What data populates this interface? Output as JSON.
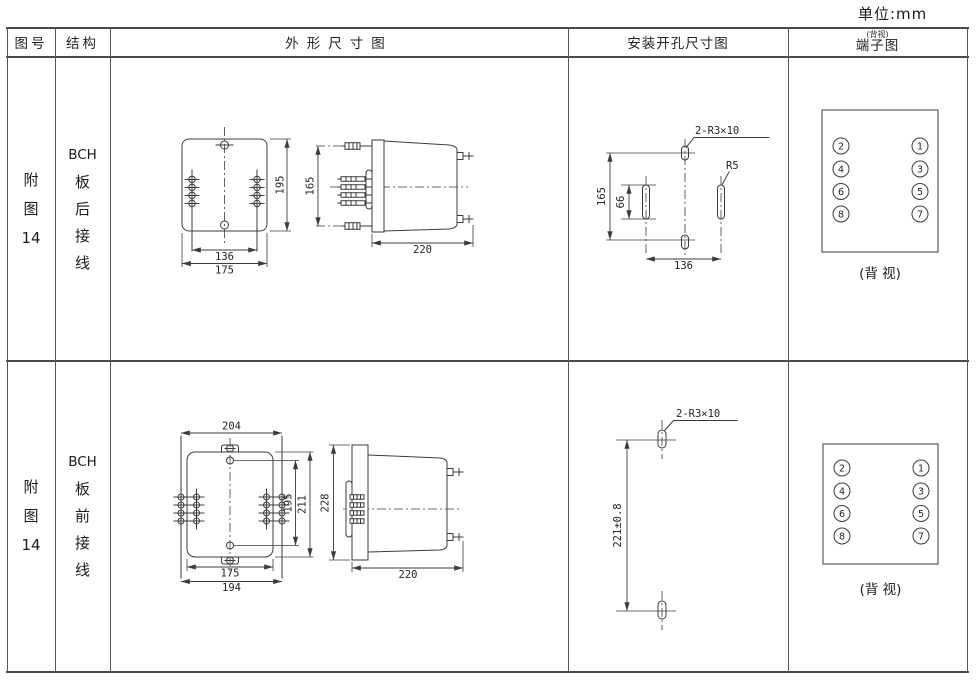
{
  "unit_label": "单位:mm",
  "header": {
    "figure_no": "图号",
    "structure": "结构",
    "outline": "外形尺寸图",
    "mounting": "安装开孔尺寸图",
    "terminal": "端子图",
    "terminal_note": "(背视)"
  },
  "rows": [
    {
      "figure_no": [
        "附",
        "图",
        "14"
      ],
      "structure": [
        "BCH",
        "板",
        "后",
        "接",
        "线"
      ],
      "outline": {
        "front_height": "195",
        "bolt_span_width": "136",
        "front_width": "175",
        "side_height": "165",
        "depth": "220"
      },
      "mounting": {
        "slot_label": "2-R3×10",
        "radius_label": "R5",
        "span_height": "165",
        "slot_height": "66",
        "span_width": "136"
      },
      "terminal": {
        "left": [
          "2",
          "4",
          "6",
          "8"
        ],
        "right": [
          "1",
          "3",
          "5",
          "7"
        ],
        "caption": "(背 视)"
      }
    },
    {
      "figure_no": [
        "附",
        "图",
        "14"
      ],
      "structure": [
        "BCH",
        "板",
        "前",
        "接",
        "线"
      ],
      "outline": {
        "stud_span_top": "204",
        "inner_height": "195",
        "front_height": "211",
        "front_width": "175",
        "stud_span_bottom": "194",
        "side_height": "228",
        "depth": "220"
      },
      "mounting": {
        "slot_label": "2-R3×10",
        "hole_spacing": "221±0.8"
      },
      "terminal": {
        "left": [
          "2",
          "4",
          "6",
          "8"
        ],
        "right": [
          "1",
          "3",
          "5",
          "7"
        ],
        "caption": "(背 视)"
      }
    }
  ]
}
